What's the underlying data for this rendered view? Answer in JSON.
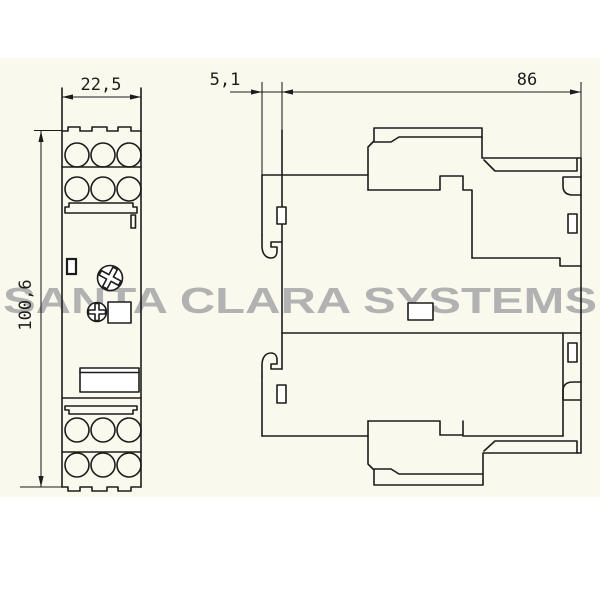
{
  "watermark": {
    "text": "SANTA CLARA SYSTEMS"
  },
  "drawing": {
    "description": "Two-view technical dimension drawing of a DIN-rail relay module",
    "front_view": {
      "width_dim": "22,5",
      "height_dim": "100,6"
    },
    "side_view": {
      "rail_offset_dim": "5,1",
      "depth_dim": "86"
    }
  },
  "colors": {
    "page_background": "#ffffff",
    "sheet_background": "#faf9ed",
    "line": "#1c1c1c",
    "watermark": "#b2b2b2"
  }
}
